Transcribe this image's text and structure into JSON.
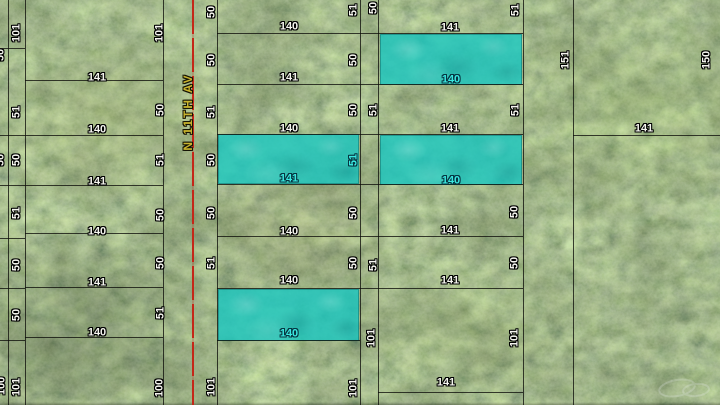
{
  "map": {
    "street": {
      "name": "N 11TH AV"
    },
    "colors": {
      "street_centerline": "#c42718",
      "street_label": "#c8b42e",
      "parcel_line": "#0e0e0a",
      "dimension_label": "#f5f5ef",
      "dimension_label_outline": "#000000",
      "highlight_fill": "#18c7c1",
      "highlight_label": "#3ae8e0"
    },
    "street_centerline": {
      "x": 193,
      "y1": 0,
      "y2": 405
    },
    "street_label_pos": {
      "x": 188,
      "y": 112
    },
    "highlighted_parcels": [
      {
        "x": 380,
        "y": 34,
        "w": 142,
        "h": 51
      },
      {
        "x": 218,
        "y": 134,
        "w": 141,
        "h": 50
      },
      {
        "x": 380,
        "y": 135,
        "w": 142,
        "h": 50
      },
      {
        "x": 218,
        "y": 289,
        "w": 141,
        "h": 52
      }
    ],
    "lines": {
      "vertical": [
        [
          8,
          0,
          405
        ],
        [
          25,
          0,
          405
        ],
        [
          163,
          0,
          405
        ],
        [
          217,
          0,
          405
        ],
        [
          360,
          0,
          405
        ],
        [
          378,
          0,
          405
        ],
        [
          523,
          0,
          405
        ],
        [
          573,
          0,
          405
        ]
      ],
      "horizontal": [
        [
          48,
          0,
          25
        ],
        [
          80,
          25,
          163
        ],
        [
          135,
          0,
          163
        ],
        [
          185,
          0,
          163
        ],
        [
          233,
          25,
          163
        ],
        [
          238,
          0,
          25
        ],
        [
          287,
          25,
          163
        ],
        [
          288,
          0,
          25
        ],
        [
          337,
          25,
          163
        ],
        [
          340,
          0,
          25
        ],
        [
          33,
          217,
          523
        ],
        [
          84,
          217,
          523
        ],
        [
          134,
          217,
          523
        ],
        [
          184,
          217,
          523
        ],
        [
          236,
          217,
          523
        ],
        [
          288,
          217,
          523
        ],
        [
          340,
          217,
          360
        ],
        [
          392,
          378,
          523
        ],
        [
          135,
          573,
          720
        ]
      ]
    },
    "labels": [
      [
        "50",
        1,
        55,
        "r"
      ],
      [
        "50",
        1,
        160,
        "r"
      ],
      [
        "100",
        2,
        386,
        "r"
      ],
      [
        "101",
        17,
        33,
        "r"
      ],
      [
        "51",
        17,
        112,
        "r"
      ],
      [
        "50",
        17,
        160,
        "r"
      ],
      [
        "51",
        17,
        213,
        "r"
      ],
      [
        "50",
        17,
        265,
        "r"
      ],
      [
        "50",
        17,
        315,
        "r"
      ],
      [
        "101",
        17,
        387,
        "r"
      ],
      [
        "101",
        160,
        33,
        "r"
      ],
      [
        "50",
        161,
        110,
        "r"
      ],
      [
        "51",
        161,
        160,
        "r"
      ],
      [
        "50",
        161,
        215,
        "r"
      ],
      [
        "50",
        161,
        263,
        "r"
      ],
      [
        "51",
        161,
        313,
        "r"
      ],
      [
        "100",
        160,
        388,
        "r"
      ],
      [
        "141",
        97,
        78,
        ""
      ],
      [
        "140",
        97,
        130,
        ""
      ],
      [
        "141",
        97,
        182,
        ""
      ],
      [
        "140",
        97,
        232,
        ""
      ],
      [
        "141",
        97,
        283,
        ""
      ],
      [
        "140",
        97,
        333,
        ""
      ],
      [
        "50",
        212,
        12,
        "r"
      ],
      [
        "50",
        212,
        60,
        "r"
      ],
      [
        "51",
        212,
        112,
        "r"
      ],
      [
        "50",
        212,
        160,
        "r"
      ],
      [
        "50",
        212,
        213,
        "r"
      ],
      [
        "51",
        212,
        263,
        "r"
      ],
      [
        "101",
        212,
        387,
        "r"
      ],
      [
        "140",
        289,
        27,
        ""
      ],
      [
        "141",
        289,
        78,
        ""
      ],
      [
        "140",
        289,
        129,
        ""
      ],
      [
        "141",
        289,
        179,
        "c"
      ],
      [
        "140",
        289,
        232,
        ""
      ],
      [
        "140",
        289,
        281,
        ""
      ],
      [
        "140",
        289,
        334,
        "c"
      ],
      [
        "51",
        354,
        10,
        "r"
      ],
      [
        "50",
        354,
        60,
        "r"
      ],
      [
        "50",
        354,
        110,
        "r"
      ],
      [
        "51",
        354,
        160,
        "rc"
      ],
      [
        "50",
        354,
        213,
        "r"
      ],
      [
        "50",
        354,
        263,
        "r"
      ],
      [
        "101",
        354,
        388,
        "r"
      ],
      [
        "50",
        374,
        8,
        "r"
      ],
      [
        "51",
        374,
        110,
        "r"
      ],
      [
        "51",
        374,
        265,
        "r"
      ],
      [
        "101",
        372,
        338,
        "r"
      ],
      [
        "141",
        450,
        28,
        ""
      ],
      [
        "140",
        451,
        80,
        "c"
      ],
      [
        "141",
        450,
        129,
        ""
      ],
      [
        "140",
        451,
        181,
        "c"
      ],
      [
        "141",
        450,
        231,
        ""
      ],
      [
        "141",
        450,
        281,
        ""
      ],
      [
        "141",
        446,
        383,
        ""
      ],
      [
        "51",
        516,
        10,
        "r"
      ],
      [
        "51",
        516,
        110,
        "r"
      ],
      [
        "50",
        515,
        212,
        "r"
      ],
      [
        "50",
        515,
        263,
        "r"
      ],
      [
        "101",
        515,
        338,
        "r"
      ],
      [
        "151",
        566,
        60,
        "r"
      ],
      [
        "150",
        707,
        60,
        "r"
      ],
      [
        "141",
        644,
        129,
        ""
      ]
    ]
  }
}
